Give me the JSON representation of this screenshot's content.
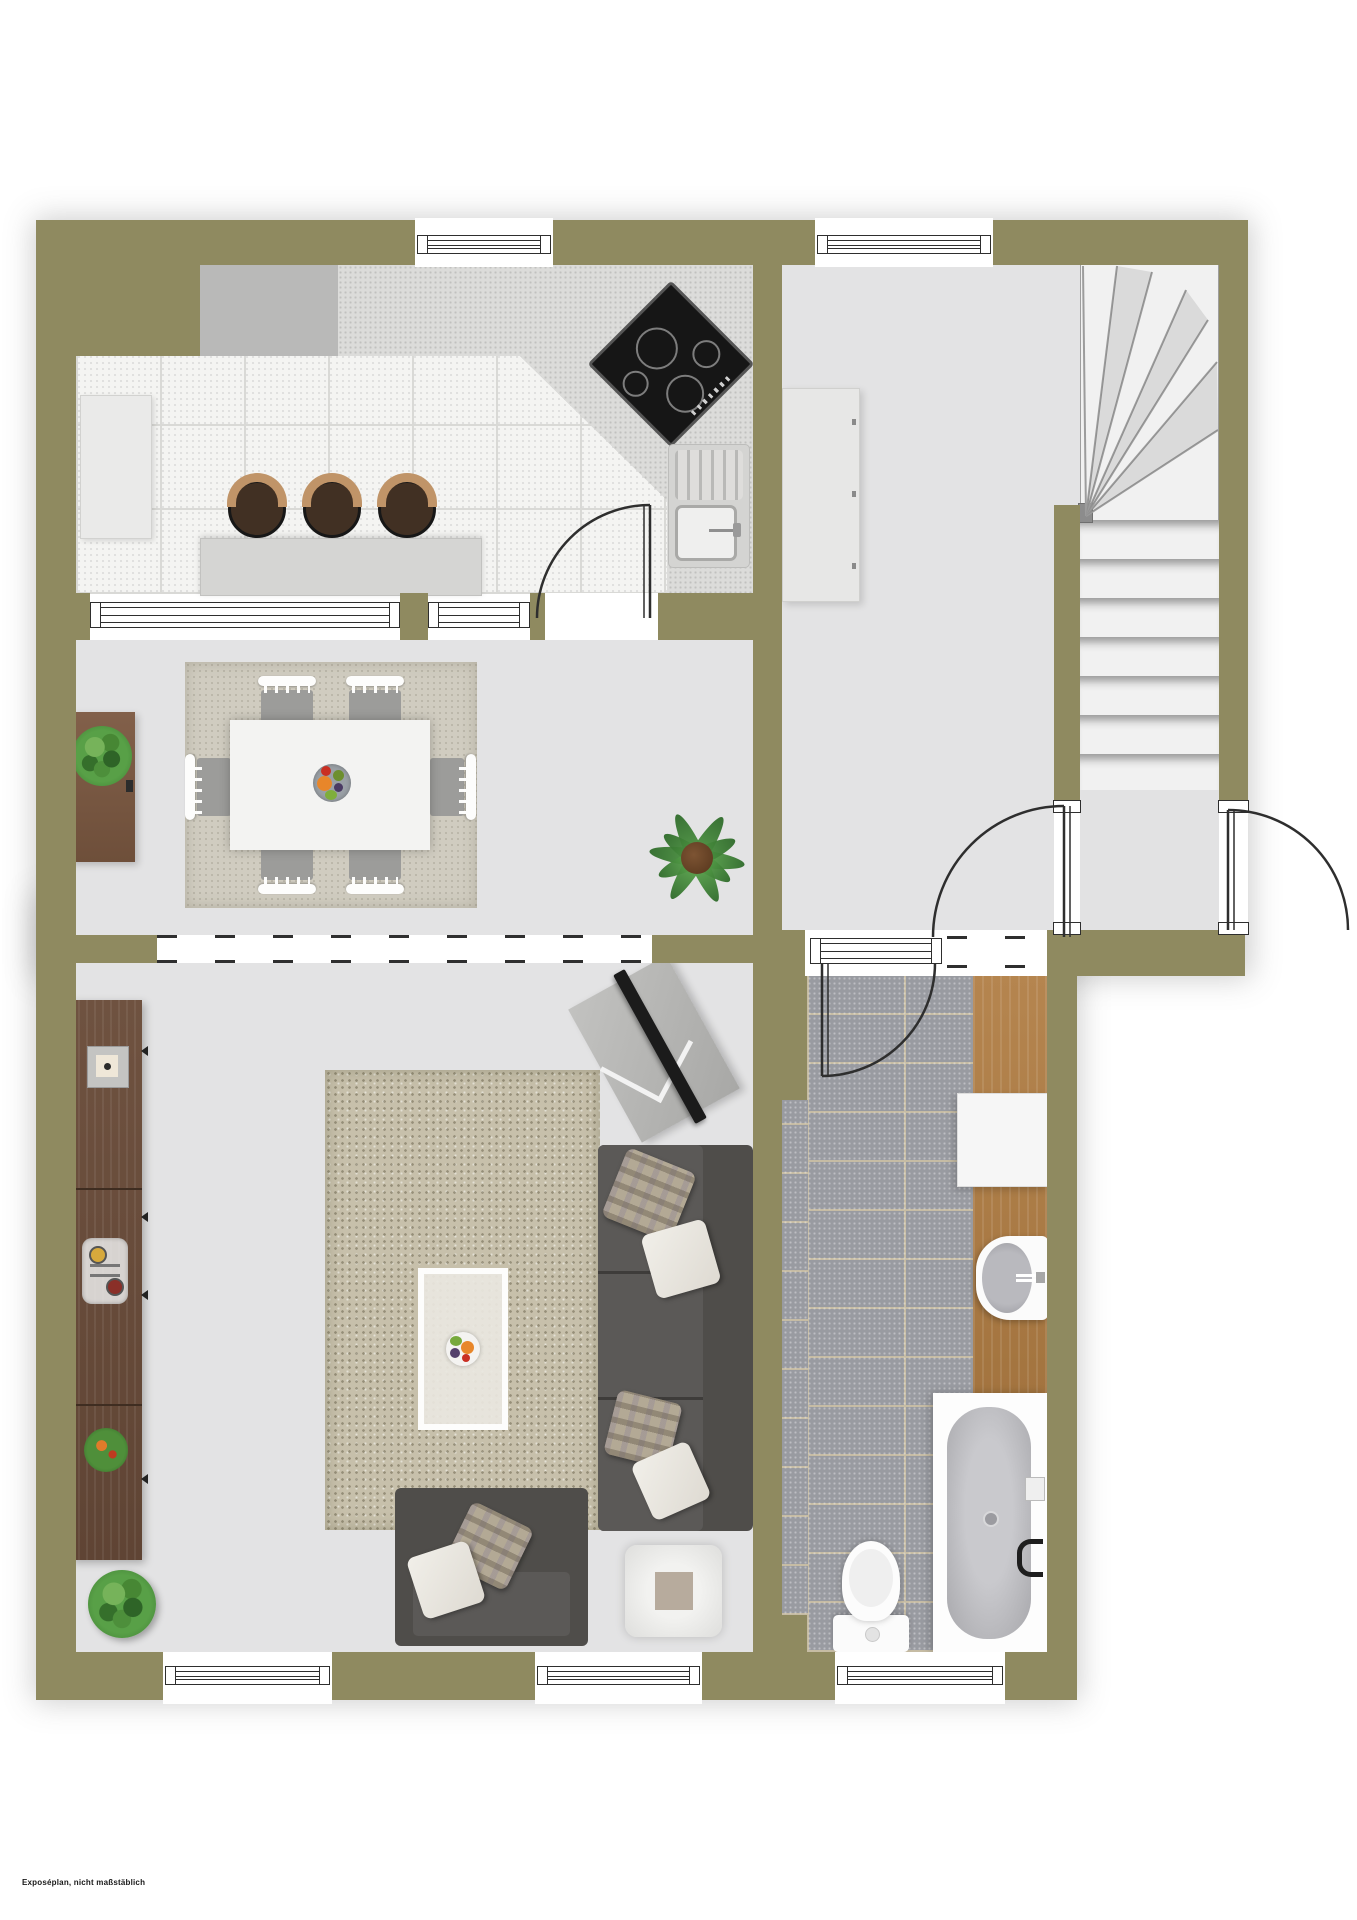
{
  "meta": {
    "type": "floor-plan rendering, top-down",
    "footnote": "Exposéplan, nicht maßstäblich"
  },
  "colors": {
    "outside": "#ffffff",
    "wall": "#8f8a60",
    "floor": "#e3e3e4",
    "ktile": "#f4f4f2",
    "grout": "#d9d9d6",
    "btile": "#999ba1",
    "bgrout": "#c6bca4",
    "wood": "#b5854f",
    "wood_dark": "#a3743f",
    "counter": "#b9b9b8",
    "counter_speck": "#dcdcda",
    "island": "#d5d5d3",
    "cooktop": "#161616",
    "sofa": "#4f4d4a",
    "seat": "#5b5957",
    "rug_dining": "#d0ccc0",
    "rug_living": "#c7c0ab",
    "stool": "#413023",
    "stool_top": "#c09468",
    "stairs": "#f1f1f1",
    "line": "#2e2e2e"
  },
  "inventory": {
    "kitchen": [
      "l-shaped-counter",
      "corner-cooktop-4-burners",
      "sink-with-drainboard",
      "island-counter",
      "bar-stools-x3",
      "tall-cabinet",
      "window"
    ],
    "hall": [
      "wardrobe",
      "window",
      "winder-staircase"
    ],
    "stair_landing": [
      "door-to-hall",
      "entrance-door",
      "transom-window-to-bath"
    ],
    "dining": [
      "table-6-chairs",
      "fruit-bowl",
      "area-rug",
      "sideboard-with-plant",
      "palm-plant",
      "door-to-kitchen",
      "open-passage-to-living"
    ],
    "living": [
      "shelf-unit",
      "area-rug",
      "coffee-table-with-fruit-bowl",
      "corner-sofa",
      "armchair",
      "side-table",
      "tv-on-stand",
      "round-plant",
      "windows-x2"
    ],
    "bath": [
      "door",
      "washing-machine",
      "washbasin",
      "bathtub",
      "toilet",
      "wood-deck-strip",
      "window"
    ]
  },
  "counts": {
    "bar_stools": 3,
    "dining_chairs": 6,
    "straight_treads": 7,
    "winder_treads": 7,
    "doors": 4,
    "windows": 6
  }
}
